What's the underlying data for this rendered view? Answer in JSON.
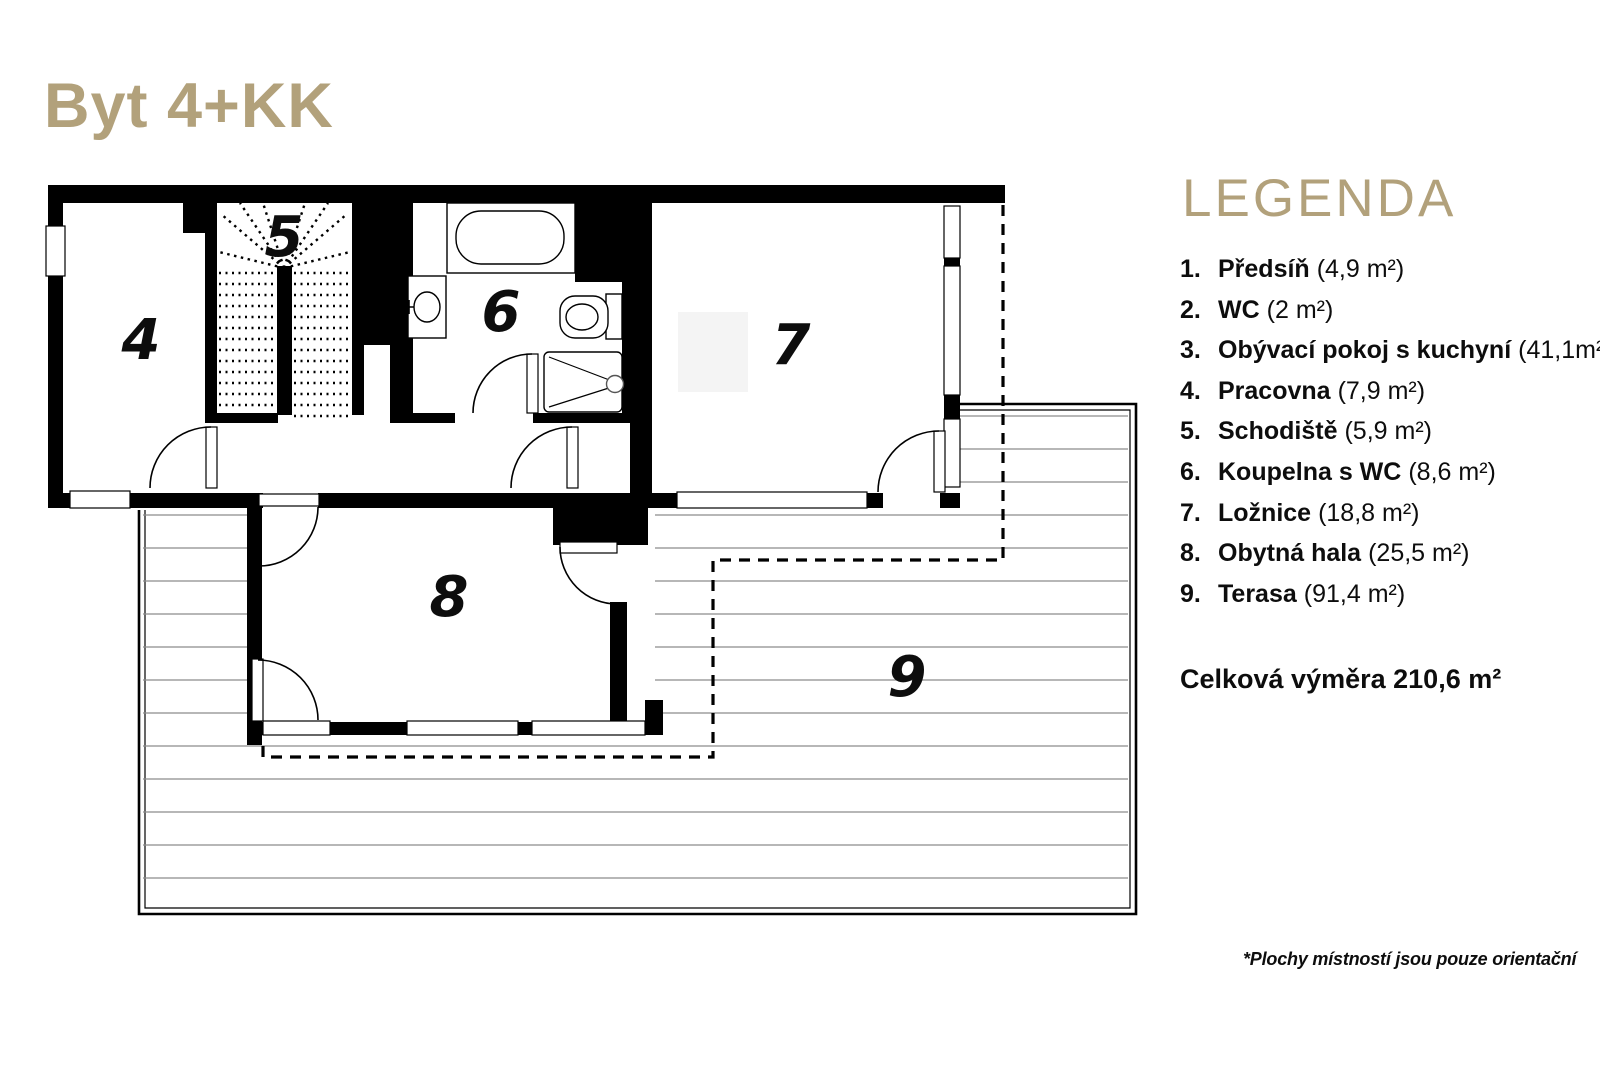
{
  "title": "Byt 4+KK",
  "legend": {
    "heading": "LEGENDA",
    "items": [
      {
        "num": "1.",
        "name": "Předsíň",
        "area": "(4,9 m²)"
      },
      {
        "num": "2.",
        "name": "WC",
        "area": "(2 m²)"
      },
      {
        "num": "3.",
        "name": "Obývací pokoj s kuchyní",
        "area": "(41,1m²)"
      },
      {
        "num": "4.",
        "name": "Pracovna",
        "area": "(7,9 m²)"
      },
      {
        "num": "5.",
        "name": "Schodiště",
        "area": "(5,9 m²)"
      },
      {
        "num": "6.",
        "name": "Koupelna s WC",
        "area": "(8,6 m²)"
      },
      {
        "num": "7.",
        "name": "Ložnice",
        "area": "(18,8 m²)"
      },
      {
        "num": "8.",
        "name": "Obytná hala",
        "area": "(25,5 m²)"
      },
      {
        "num": "9.",
        "name": "Terasa",
        "area": "(91,4 m²)"
      }
    ],
    "total": "Celková výměra 210,6 m²"
  },
  "plan": {
    "room_numbers": [
      "4",
      "5",
      "6",
      "7",
      "8",
      "9"
    ]
  },
  "footnote": "*Plochy místností jsou pouze orientační",
  "colors": {
    "gold": "#b2a17b",
    "ink": "#0d0d0d",
    "deck_line": "#8c8c8c"
  }
}
